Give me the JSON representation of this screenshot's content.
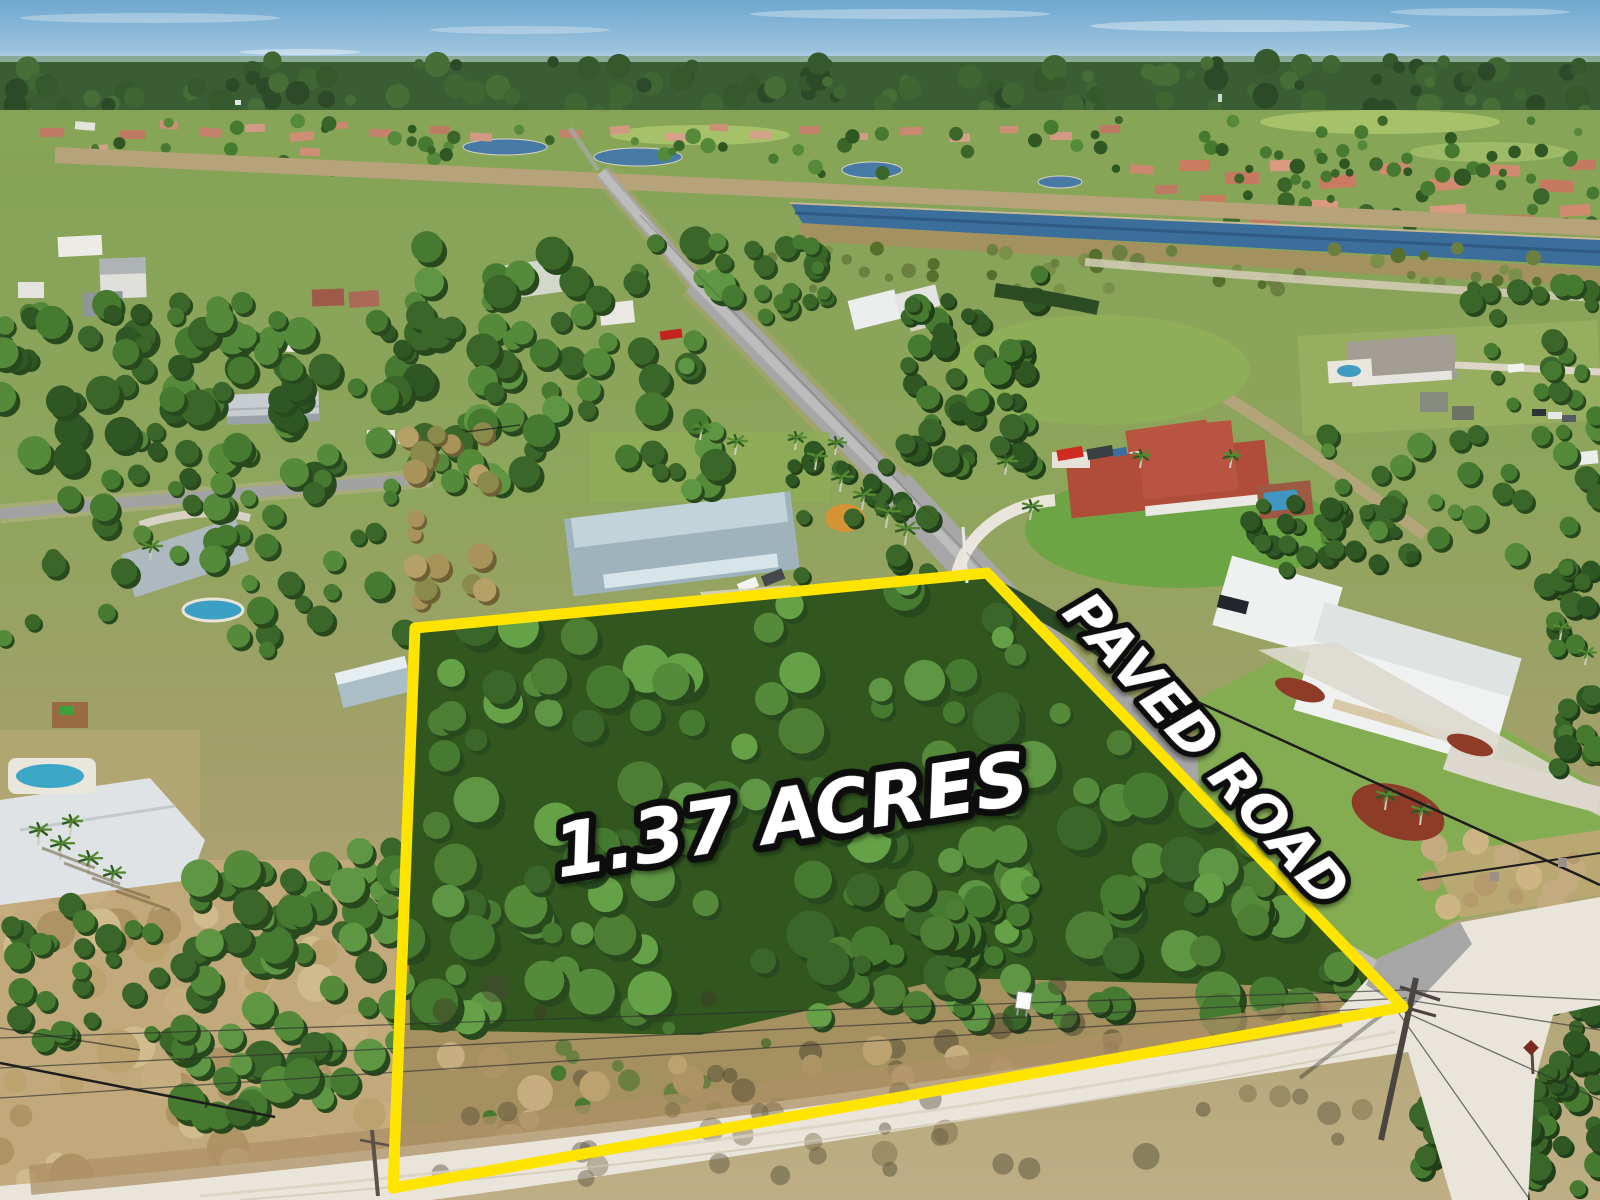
{
  "overlay": {
    "acreage_label": "1.37 ACRES",
    "road_label": "PAVED ROAD",
    "boundary_color": "#ffe400",
    "label_fill": "#ffffff",
    "label_outline": "#0b0b0b"
  },
  "scene": {
    "type": "aerial-drone-real-estate-photo",
    "subject": "vacant wooded 1.37 acre corner lot outlined in yellow",
    "colors": {
      "sky_top": "#6ea7cf",
      "sky_horizon": "#cfe4ee",
      "far_forest": "#3a5d33",
      "canal_water": "#3c6e9c",
      "pond_water": "#477ba6",
      "lot_canopy": "#477a31",
      "dry_grass": "#c1a97c",
      "asphalt_road": "#a6a6a6",
      "sand_road": "#e9e5da",
      "lawn": "#7fae4c",
      "tile_roof": "#b04c3a",
      "metal_roof": "#eef1f0"
    },
    "landmarks": [
      "paved road running diagonally to a sand-road intersection",
      "canal with waterfront development behind",
      "red tile roof estate",
      "white metal roof estate with fenced lawn",
      "blue two-story house by lot corner",
      "utility pole and wires at intersection",
      "small for-sale sign on lot frontage"
    ]
  }
}
